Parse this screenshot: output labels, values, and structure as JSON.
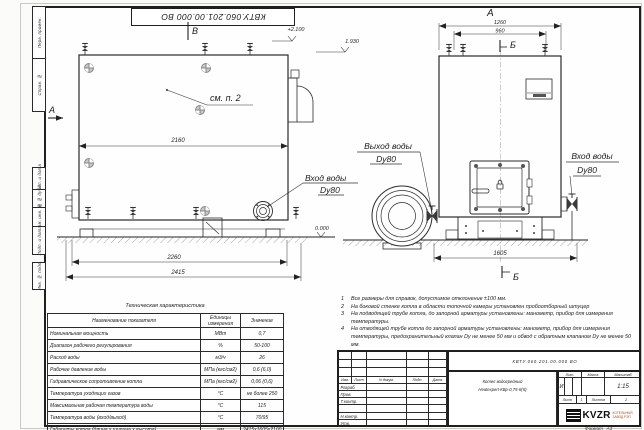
{
  "sheet": {
    "stamp_rotated": "КВТУ.060.201.00.000  ВО",
    "format_label": "Формат",
    "format_value": "А3"
  },
  "margin_labels": [
    "Перв. примен.",
    "Справ. №",
    "Подп. и дата",
    "Инв. № дубл.",
    "Взам. инв. №",
    "Подп. и дата",
    "Инв. № подл."
  ],
  "drawing": {
    "view_b_marker": "В",
    "view_a_marker": "А",
    "view_a_title": "А",
    "section_b_top": "Б",
    "section_b_bottom": "Б",
    "see_item": "см. п. 2",
    "elev_plus2100": "+2.100",
    "elev_1930": "1.930",
    "elev_zero": "0.000",
    "dim_2160": "2160",
    "dim_2260": "2260",
    "dim_2415": "2415",
    "dim_1260": "1260",
    "dim_960": "960",
    "dim_1605": "1605",
    "outlet_line1": "Выход воды",
    "outlet_line2": "Dy80",
    "inlet_left_line1": "Вход воды",
    "inlet_left_line2": "Dy80",
    "inlet_right_line1": "Вход воды",
    "inlet_right_line2": "Dy80"
  },
  "tech_table": {
    "title": "Техническая характеристика",
    "headers": [
      "Наименование показателя",
      "Единицы измерения",
      "Значение"
    ],
    "rows": [
      [
        "Номинальная мощность",
        "МВт",
        "0,7"
      ],
      [
        "Диапазон рабочего регулирования",
        "%",
        "50-100"
      ],
      [
        "Расход воды",
        "м3/ч",
        "26"
      ],
      [
        "Рабочее давление воды",
        "МПа (кгс/см2)",
        "0,6 (6,0)"
      ],
      [
        "Гидравлическое сопротивление котла",
        "МПа (кгс/см2)",
        "0,06 (0,6)"
      ],
      [
        "Температура уходящих газов",
        "°С",
        "не более 250"
      ],
      [
        "Максимальная рабочая температура воды",
        "°С",
        "115"
      ],
      [
        "Температура воды (вход/выход)",
        "°С",
        "70/95"
      ],
      [
        "Габариты котла (длина х ширина х высота)",
        "мм",
        "2415х1605х2100"
      ]
    ]
  },
  "notes": [
    {
      "n": "1",
      "text": "Все размеры для справок, допустимое отклонение ±100 мм."
    },
    {
      "n": "2",
      "text": "На боковой стенке котла в области топочной камеры установлен пробоотборный штуцер"
    },
    {
      "n": "3",
      "text": "На  подводящей трубе котла, до запорной арматуры установлены: манометр, прибор для измерения температуры."
    },
    {
      "n": "4",
      "text": "На отводящей трубе котла до запорной арматуры установлены: манометр, прибор для измерения температуры, предохранительный клапан Dу не менее 50 мм и обвод с обратным клапаном Dу не менее 50 мм."
    }
  ],
  "title_block": {
    "doc_number": "КВТУ.060.201.00.000  ВО",
    "cols": [
      "Изм.",
      "Лист",
      "N докум.",
      "Подп.",
      "Дата"
    ],
    "rows": [
      "Разраб.",
      "Пров.",
      "Т.контр.",
      "",
      "Н.контр.",
      "Утв."
    ],
    "product_line1": "Котел водогрейный",
    "product_line2": "Heatexpert-КВр-0,75-К(К)",
    "lit_label": "Лит.",
    "mass_label": "Масса",
    "scale_label": "Масштаб",
    "lit_value": "И",
    "scale_value": "1:15",
    "sheet_label": "Лист",
    "sheet_value": "1",
    "sheets_label": "Листов",
    "sheets_value": "2",
    "brand": "KVZR",
    "brand_line1": "КОТЕЛЬНЫЙ",
    "brand_line2": "ЗАВОД РЭП"
  }
}
